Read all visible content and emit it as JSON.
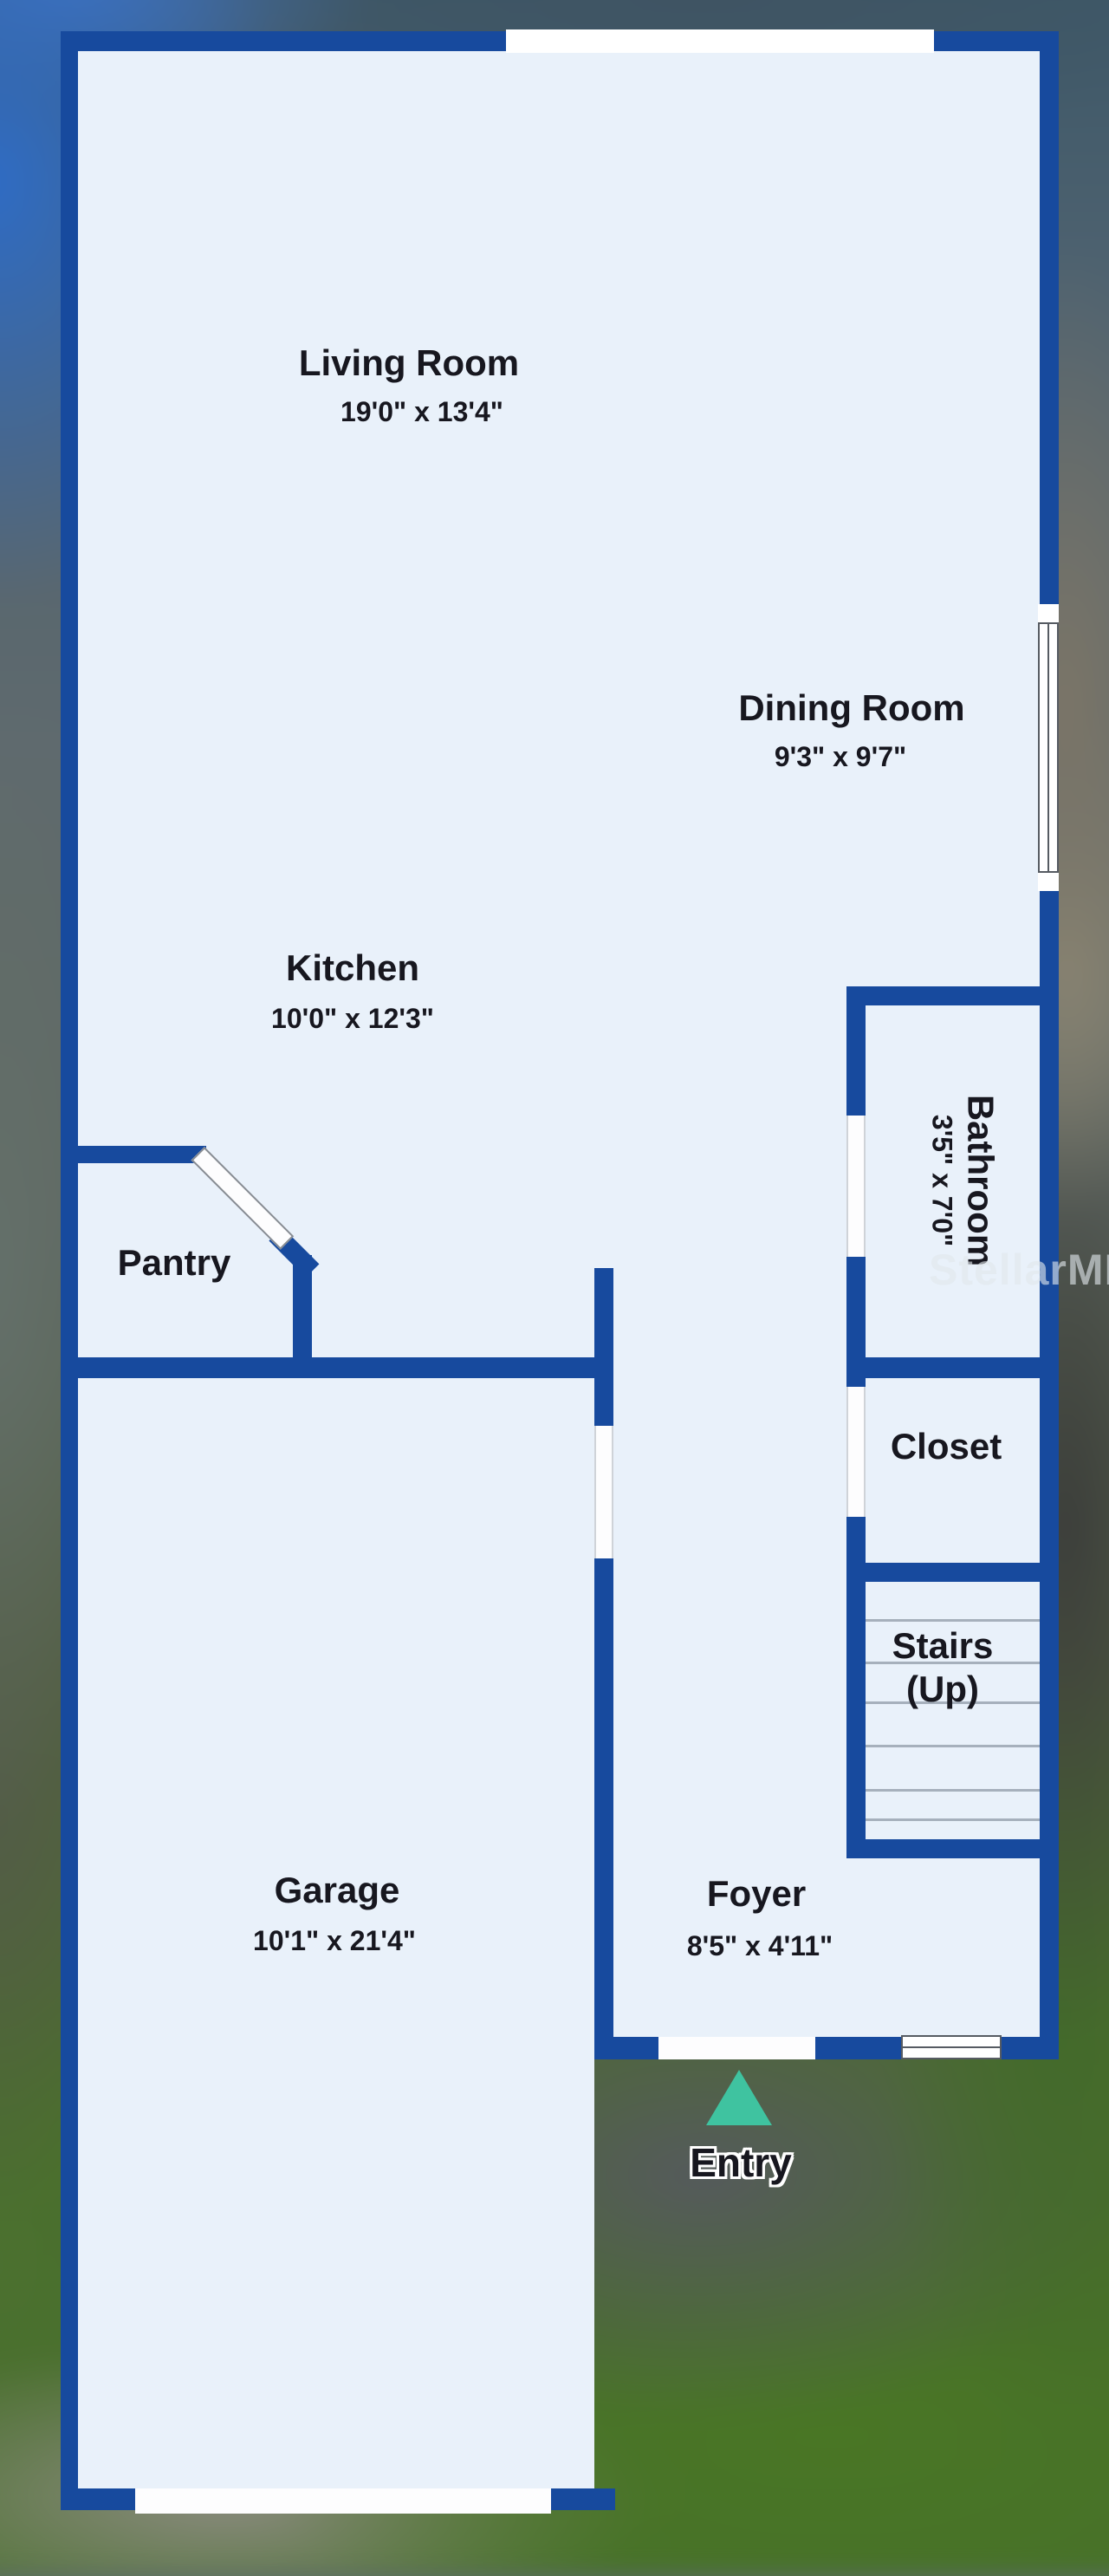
{
  "plan": {
    "rooms": [
      {
        "id": "living-room",
        "name": "Living Room",
        "dimensions": "19'0\" x 13'4\""
      },
      {
        "id": "dining-room",
        "name": "Dining Room",
        "dimensions": "9'3\" x 9'7\""
      },
      {
        "id": "kitchen",
        "name": "Kitchen",
        "dimensions": "10'0\" x 12'3\""
      },
      {
        "id": "pantry",
        "name": "Pantry",
        "dimensions": ""
      },
      {
        "id": "bathroom",
        "name": "Bathroom",
        "dimensions": "3'5\" x 7'0\""
      },
      {
        "id": "closet",
        "name": "Closet",
        "dimensions": ""
      },
      {
        "id": "stairs",
        "name": "Stairs (Up)",
        "line1": "Stairs",
        "line2": "(Up)",
        "dimensions": ""
      },
      {
        "id": "garage",
        "name": "Garage",
        "dimensions": "10'1\" x 21'4\""
      },
      {
        "id": "foyer",
        "name": "Foyer",
        "dimensions": "8'5\" x 4'11\""
      }
    ],
    "entry_label": "Entry",
    "watermark": "StellarMLS",
    "colors": {
      "wall": "#174a9e",
      "floor": "#e9f1fa",
      "door": "#fdfdfe",
      "text": "#17171f",
      "arrow": "#3fc3a0",
      "tread": "#a6b0bc",
      "window-frame": "#565b62",
      "watermark": "rgba(224,230,236,0.62)"
    }
  }
}
